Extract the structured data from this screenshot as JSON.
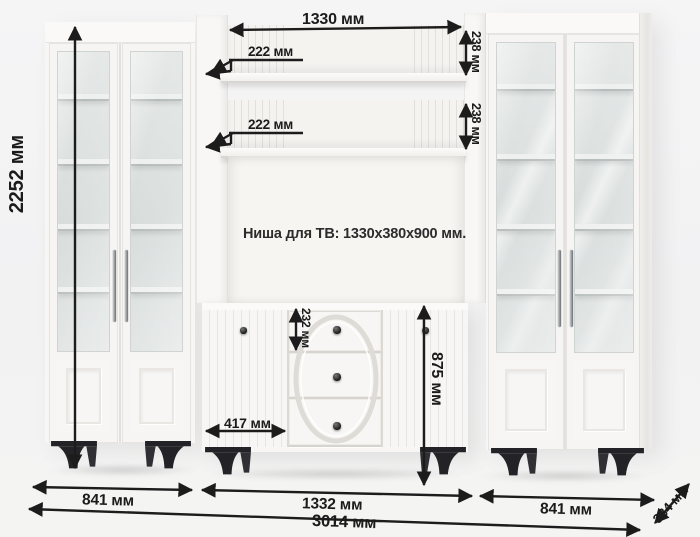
{
  "diagram": {
    "tv_niche_note": "Ниша для ТВ: 1330x380x900 мм.",
    "dims": {
      "total_height": "2252 мм",
      "top_inner_width": "1330 мм",
      "shelf_depth_upper": "222 мм",
      "shelf_depth_lower": "222 мм",
      "shelf_back_height_upper": "238 мм",
      "shelf_back_height_lower": "238 мм",
      "drawer_height": "232 мм",
      "stand_door_width": "417 мм",
      "stand_height": "875 мм",
      "left_cabinet_width": "841 мм",
      "center_section_width": "1332 мм",
      "right_cabinet_width": "841 мм",
      "total_width": "3014 мм",
      "depth": "384 мм"
    },
    "colors": {
      "background": "#f2f2f3",
      "furniture_white": "#f7f6f4",
      "dimension_ink": "#1c1c1c",
      "leg_black": "#242428",
      "glass_interior": "#d9dedd"
    }
  }
}
